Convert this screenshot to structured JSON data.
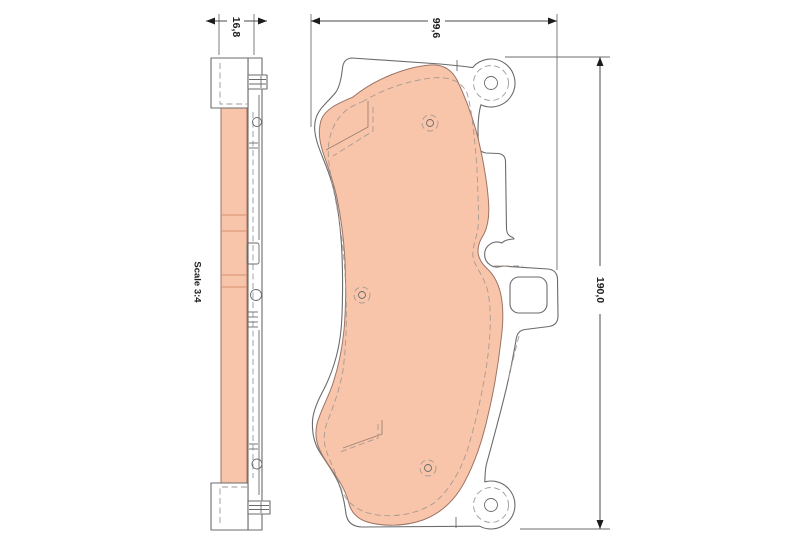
{
  "drawing": {
    "scale_label": "Scale 3:4",
    "dimensions": {
      "thickness": "16,8",
      "width": "99,6",
      "height": "190,0"
    },
    "colors": {
      "background": "#ffffff",
      "friction_material_fill": "#f8c5ab",
      "friction_material_outline": "#9c7365",
      "plate_outline": "#6b6b6b",
      "hidden_line": "#a89a90",
      "dimension_line": "#4a4a4a",
      "text": "#1c1c1c"
    }
  }
}
